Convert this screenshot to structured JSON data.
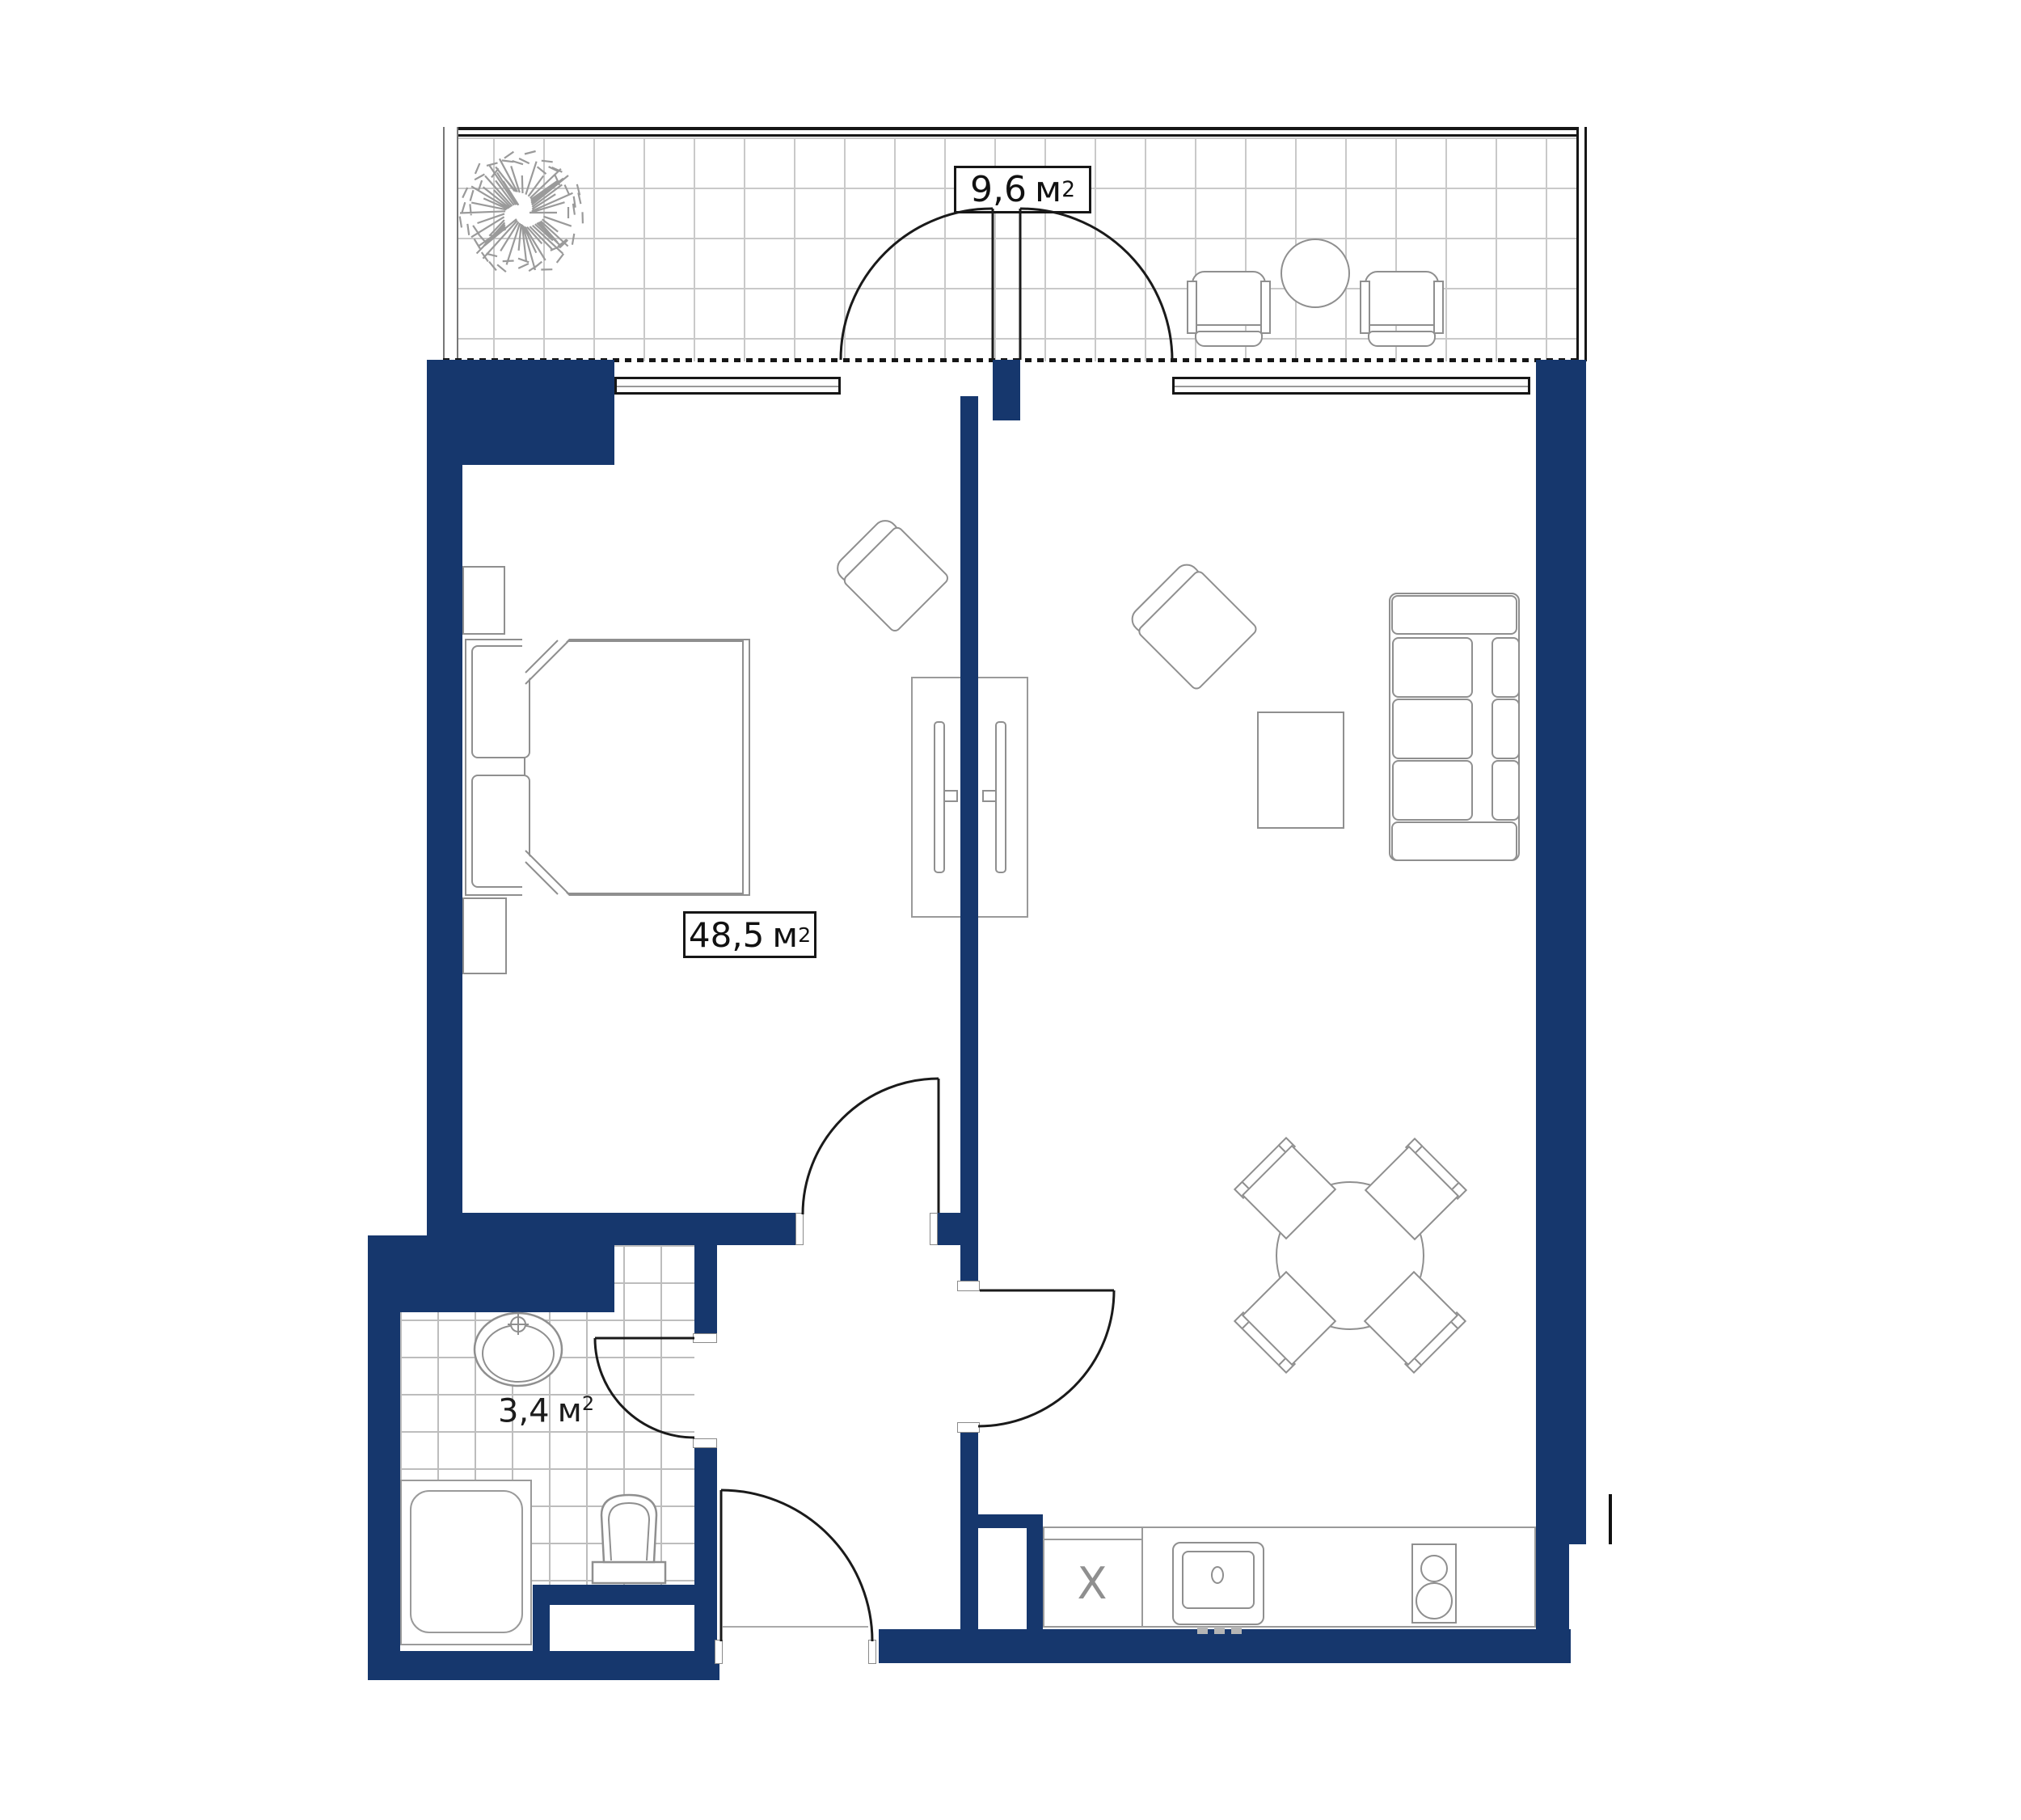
{
  "title": "apartment-floor-plan",
  "colors": {
    "wall": "#16376d",
    "furniture_line": "#8f8f8f",
    "black_line": "#161616",
    "balcony_grid": "#c9c9c9",
    "bathroom_grid": "#bdbdbd"
  },
  "labels": {
    "balcony_area": {
      "value": "9,6",
      "unit": "м",
      "sup": "2"
    },
    "apartment_area": {
      "value": "48,5",
      "unit": "м",
      "sup": "2"
    },
    "bathroom_area": {
      "value": "3,4",
      "unit": "м",
      "sup": "2"
    },
    "fridge_mark": "Х"
  }
}
